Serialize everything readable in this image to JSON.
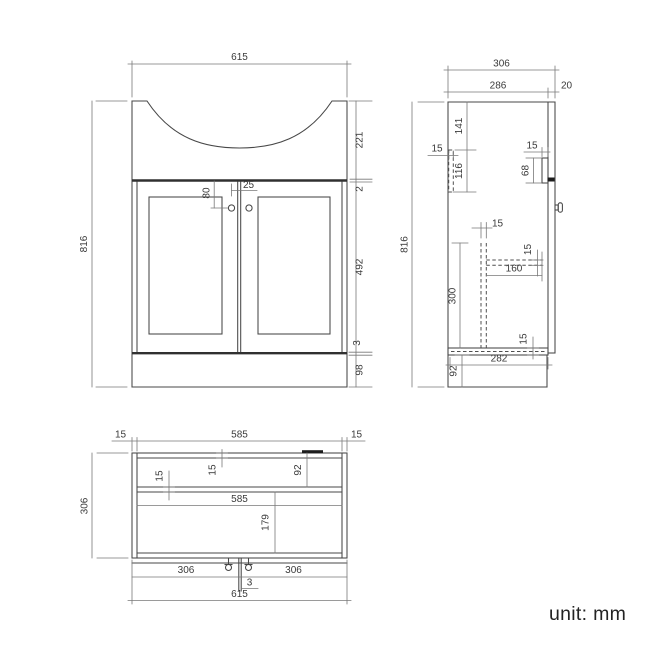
{
  "page": {
    "unit_label": "unit: mm"
  },
  "front_view": {
    "dims": {
      "overall_width": "615",
      "overall_height": "816",
      "basin_section_height": "221",
      "counter_edge": "2",
      "door_height": "492",
      "door_bottom_gap": "3",
      "plinth_height": "98",
      "knob_top_offset": "80",
      "knob_side_offset": "25"
    }
  },
  "side_view": {
    "dims": {
      "overall_depth": "306",
      "carcass_depth": "286",
      "door_thickness": "20",
      "overall_height": "816",
      "rail_top_offset": "141",
      "rail_height": "116",
      "rail_thickness": "15",
      "catch_thickness": "15",
      "catch_height": "68",
      "divider_thickness": "15",
      "divider_height": "300",
      "shelf_depth": "160",
      "shelf_thickness": "15",
      "bottom_thickness": "15",
      "bottom_inner_depth": "282",
      "plinth_height": "92"
    }
  },
  "plan_view": {
    "dims": {
      "left_panel_thickness": "15",
      "inner_width": "585",
      "right_panel_thickness": "15",
      "overall_depth": "306",
      "rail_thickness": "15",
      "top_panel_thickness": "15",
      "back_section_depth": "92",
      "mid_inner_width": "585",
      "front_section_depth": "179",
      "left_door_width": "306",
      "right_door_width": "306",
      "door_gap": "3",
      "overall_width": "615"
    }
  }
}
